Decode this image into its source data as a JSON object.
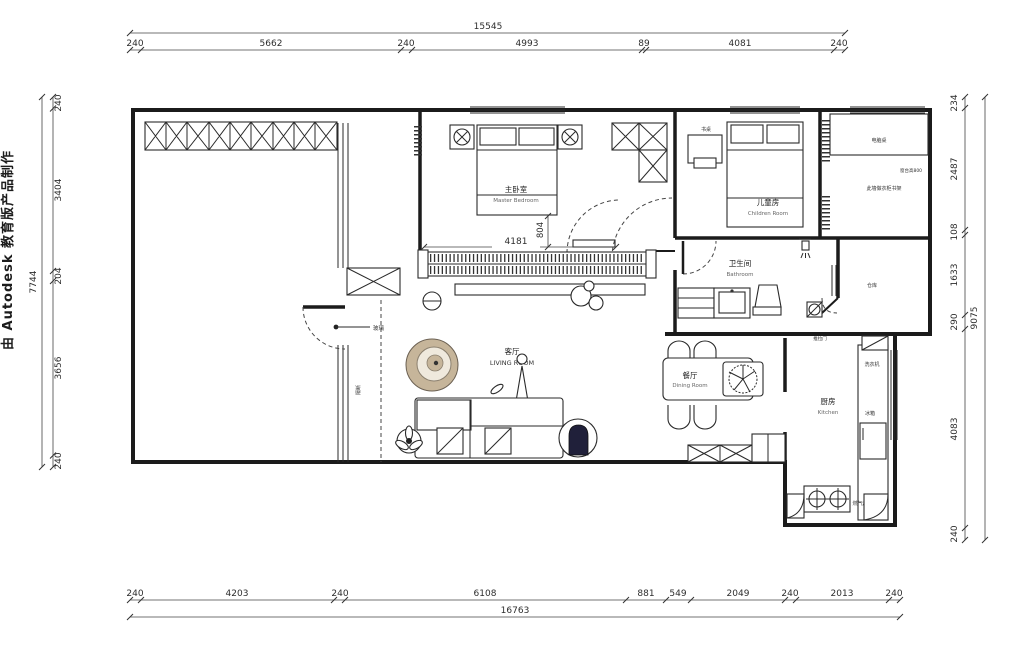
{
  "watermark": "由 Autodesk 教育版产品制作",
  "dimensions": {
    "top": {
      "total": "15545",
      "segments": [
        "240",
        "5662",
        "240",
        "4993",
        "89",
        "4081",
        "240"
      ]
    },
    "bottom": {
      "total": "16763",
      "segments": [
        "240",
        "4203",
        "240",
        "6108",
        "881",
        "549",
        "2049",
        "240",
        "2013",
        "240"
      ]
    },
    "left": {
      "total": "7744",
      "segments": [
        "240",
        "3404",
        "204",
        "3656",
        "240"
      ]
    },
    "right": {
      "total": "9075",
      "segments": [
        "234",
        "2487",
        "108",
        "1633",
        "290",
        "4083",
        "240"
      ]
    },
    "interior": {
      "wardrobe_length": "4181",
      "door_width": "804"
    }
  },
  "rooms": {
    "master_bedroom": {
      "zh": "主卧室",
      "en": "Master Bedroom"
    },
    "children_room": {
      "zh": "儿童房",
      "en": "Children Room"
    },
    "bathroom": {
      "zh": "卫生间",
      "en": "Bathroom"
    },
    "living_room": {
      "zh": "客厅",
      "en": "LIVING ROOM"
    },
    "dining_room": {
      "zh": "餐厅",
      "en": "Dining Room"
    },
    "kitchen": {
      "zh": "厨房",
      "en": "Kitchen"
    },
    "storage": {
      "zh": "仓库"
    }
  },
  "annotations": {
    "desk": "书桌",
    "computer_desk": "电脑桌",
    "study_note": "此墙做衣柜书架",
    "window_note": "窗台高800",
    "washing_machine": "洗衣机",
    "fridge": "冰箱",
    "gas_stove": "燃气灶",
    "sliding_door": "推拉门",
    "glass": "玻璃",
    "partition": "隔断"
  },
  "colors": {
    "accent_tan": "#c6b59a",
    "dark_navy": "#20203a",
    "line": "#1b1b1b"
  }
}
